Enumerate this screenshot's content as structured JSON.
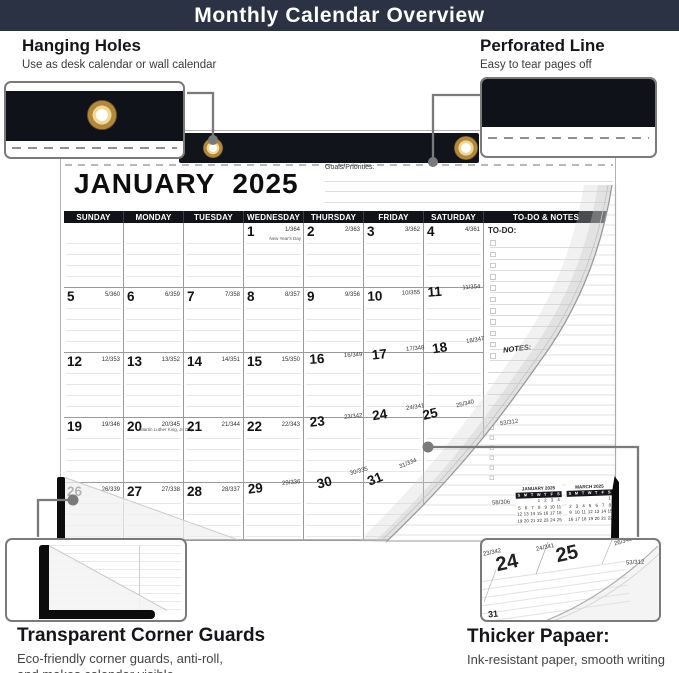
{
  "banner": {
    "title": "Monthly Calendar Overview"
  },
  "callouts": {
    "hanging_holes": {
      "title": "Hanging Holes",
      "subtitle": "Use as desk calendar or wall calendar"
    },
    "perforated_line": {
      "title": "Perforated Line",
      "subtitle": "Easy to tear pages off"
    },
    "corner_guards": {
      "title": "Transparent Corner Guards",
      "line1": "Eco-friendly corner guards, anti-roll,",
      "line2": "and makes calendar visible"
    },
    "thicker_paper": {
      "title": "Thicker Papaer:",
      "subtitle": "Ink-resistant paper, smooth writing"
    }
  },
  "calendar": {
    "month": "JANUARY",
    "year": "2025",
    "goals_label": "Goals/Priorities:",
    "day_headers": [
      "SUNDAY",
      "MONDAY",
      "TUESDAY",
      "WEDNESDAY",
      "THURSDAY",
      "FRIDAY",
      "SATURDAY",
      "TO-DO & NOTES"
    ],
    "todo_label": "TO-DO:",
    "notes_label": "NOTES:",
    "weeks": [
      [
        {
          "d": "",
          "j": "",
          "h": ""
        },
        {
          "d": "",
          "j": "",
          "h": ""
        },
        {
          "d": "",
          "j": "",
          "h": ""
        },
        {
          "d": "1",
          "j": "1/364",
          "h": "New Year's Day"
        },
        {
          "d": "2",
          "j": "2/363",
          "h": ""
        },
        {
          "d": "3",
          "j": "3/362",
          "h": ""
        },
        {
          "d": "4",
          "j": "4/361",
          "h": ""
        }
      ],
      [
        {
          "d": "5",
          "j": "5/360",
          "h": ""
        },
        {
          "d": "6",
          "j": "6/359",
          "h": ""
        },
        {
          "d": "7",
          "j": "7/358",
          "h": ""
        },
        {
          "d": "8",
          "j": "8/357",
          "h": ""
        },
        {
          "d": "9",
          "j": "9/356",
          "h": ""
        },
        {
          "d": "10",
          "j": "10/355",
          "h": ""
        },
        {
          "d": "11",
          "j": "11/354",
          "h": ""
        }
      ],
      [
        {
          "d": "12",
          "j": "12/353",
          "h": ""
        },
        {
          "d": "13",
          "j": "13/352",
          "h": ""
        },
        {
          "d": "14",
          "j": "14/351",
          "h": ""
        },
        {
          "d": "15",
          "j": "15/350",
          "h": ""
        },
        {
          "d": "16",
          "j": "16/349",
          "h": ""
        },
        {
          "d": "17",
          "j": "17/348",
          "h": ""
        },
        {
          "d": "18",
          "j": "18/347",
          "h": ""
        }
      ],
      [
        {
          "d": "19",
          "j": "19/346",
          "h": ""
        },
        {
          "d": "20",
          "j": "20/345",
          "h": "Martin Luther King, Jr. Day"
        },
        {
          "d": "21",
          "j": "21/344",
          "h": ""
        },
        {
          "d": "22",
          "j": "22/343",
          "h": ""
        },
        {
          "d": "23",
          "j": "23/342",
          "h": ""
        },
        {
          "d": "24",
          "j": "24/341",
          "h": ""
        },
        {
          "d": "25",
          "j": "25/340",
          "h": ""
        }
      ],
      [
        {
          "d": "26",
          "j": "26/339",
          "h": ""
        },
        {
          "d": "27",
          "j": "27/338",
          "h": ""
        },
        {
          "d": "28",
          "j": "28/337",
          "h": ""
        },
        {
          "d": "29",
          "j": "29/336",
          "h": ""
        },
        {
          "d": "30",
          "j": "30/335",
          "h": ""
        },
        {
          "d": "31",
          "j": "31/334",
          "h": ""
        },
        {
          "d": "",
          "j": "",
          "h": ""
        }
      ]
    ]
  },
  "underpage": {
    "julian_a": "53/312",
    "julian_b": "58/306",
    "minis": [
      {
        "title": "JANUARY 2025",
        "dow": [
          "S",
          "M",
          "T",
          "W",
          "T",
          "F",
          "S"
        ],
        "rows": [
          [
            "",
            "",
            "",
            "1",
            "2",
            "3",
            "4"
          ],
          [
            "5",
            "6",
            "7",
            "8",
            "9",
            "10",
            "11"
          ],
          [
            "12",
            "13",
            "14",
            "15",
            "16",
            "17",
            "18"
          ],
          [
            "19",
            "20",
            "21",
            "22",
            "23",
            "24",
            "25"
          ]
        ]
      },
      {
        "title": "MARCH 2025",
        "dow": [
          "S",
          "M",
          "T",
          "W",
          "T",
          "F",
          "S"
        ],
        "rows": [
          [
            "",
            "",
            "",
            "",
            "",
            "",
            "1"
          ],
          [
            "2",
            "3",
            "4",
            "5",
            "6",
            "7",
            "8"
          ],
          [
            "9",
            "10",
            "11",
            "12",
            "13",
            "14",
            "15"
          ],
          [
            "16",
            "17",
            "18",
            "19",
            "20",
            "21",
            "22"
          ]
        ]
      }
    ]
  },
  "curl_thumb": {
    "d24": "24",
    "d25": "25",
    "j23": "23/342",
    "j24": "24/341",
    "j26": "26/340",
    "j53": "53/312",
    "d31": "31"
  },
  "colors": {
    "banner": "#2b3244",
    "binding_black": "#12141c",
    "grommet_gold": "#c6a14f"
  }
}
